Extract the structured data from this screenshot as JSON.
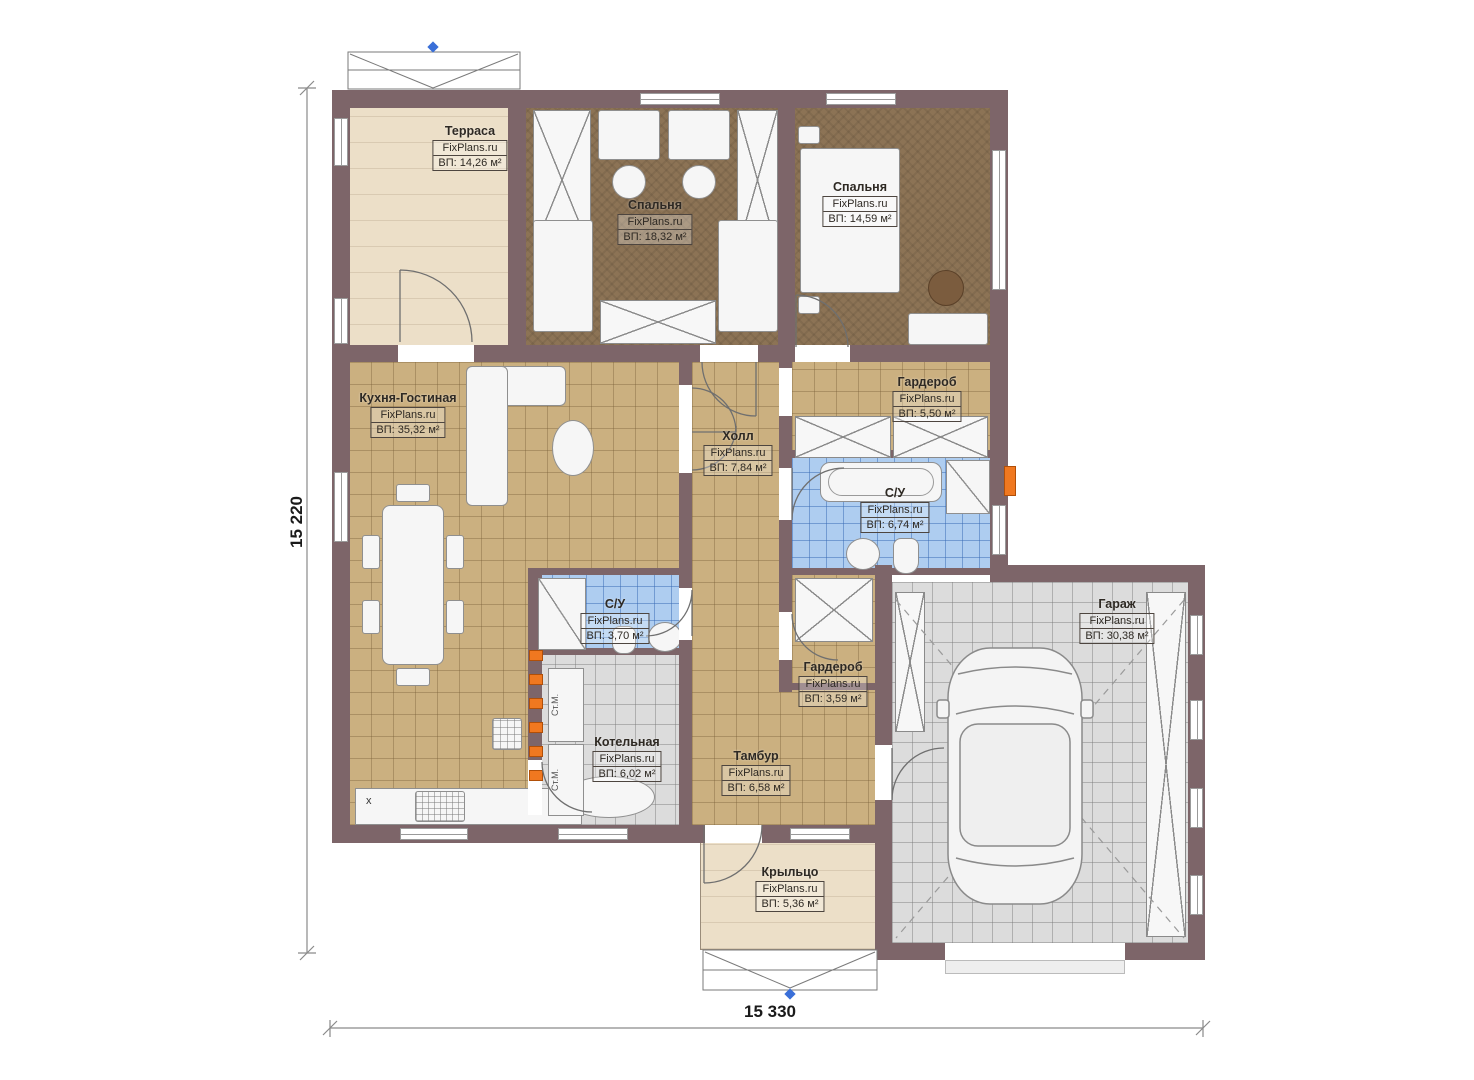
{
  "plan": {
    "watermark": "FixPlans.ru",
    "rooms": [
      {
        "id": "terrace",
        "name": "Терраса",
        "watermark": "FixPlans.ru",
        "area": "ВП: 14,26 м²"
      },
      {
        "id": "bedroom-1",
        "name": "Спальня",
        "watermark": "FixPlans.ru",
        "area": "ВП: 18,32 м²"
      },
      {
        "id": "bedroom-2",
        "name": "Спальня",
        "watermark": "FixPlans.ru",
        "area": "ВП: 14,59 м²"
      },
      {
        "id": "kitchen-living",
        "name": "Кухня-Гостиная",
        "watermark": "FixPlans.ru",
        "area": "ВП: 35,32 м²"
      },
      {
        "id": "hall",
        "name": "Холл",
        "watermark": "FixPlans.ru",
        "area": "ВП: 7,84 м²"
      },
      {
        "id": "wardrobe-1",
        "name": "Гардероб",
        "watermark": "FixPlans.ru",
        "area": "ВП: 5,50 м²"
      },
      {
        "id": "bathroom-1",
        "name": "С/У",
        "watermark": "FixPlans.ru",
        "area": "ВП: 6,74 м²"
      },
      {
        "id": "bathroom-2",
        "name": "С/У",
        "watermark": "FixPlans.ru",
        "area": "ВП: 3,70 м²"
      },
      {
        "id": "wardrobe-2",
        "name": "Гардероб",
        "watermark": "FixPlans.ru",
        "area": "ВП: 3,59 м²"
      },
      {
        "id": "boiler-room",
        "name": "Котельная",
        "watermark": "FixPlans.ru",
        "area": "ВП: 6,02 м²"
      },
      {
        "id": "vestibule",
        "name": "Тамбур",
        "watermark": "FixPlans.ru",
        "area": "ВП: 6,58 м²"
      },
      {
        "id": "porch",
        "name": "Крыльцо",
        "watermark": "FixPlans.ru",
        "area": "ВП: 5,36 м²"
      },
      {
        "id": "garage",
        "name": "Гараж",
        "watermark": "FixPlans.ru",
        "area": "ВП: 30,38 м²"
      }
    ],
    "dimensions": {
      "vertical": "15 220",
      "horizontal": "15 330"
    },
    "appliance_labels": {
      "washer": "Ст.М.",
      "counter_mark": "х"
    },
    "colors": {
      "wall": "#7d6569",
      "tan_floor": "#cbb080",
      "bedroom_floor": "#8c7355",
      "blue_floor": "#aecdf0",
      "gray_floor": "#dcdcdc",
      "beige_floor": "#ecdfc8",
      "accent_orange": "#f07820",
      "marker_blue": "#3a6fd8"
    }
  }
}
